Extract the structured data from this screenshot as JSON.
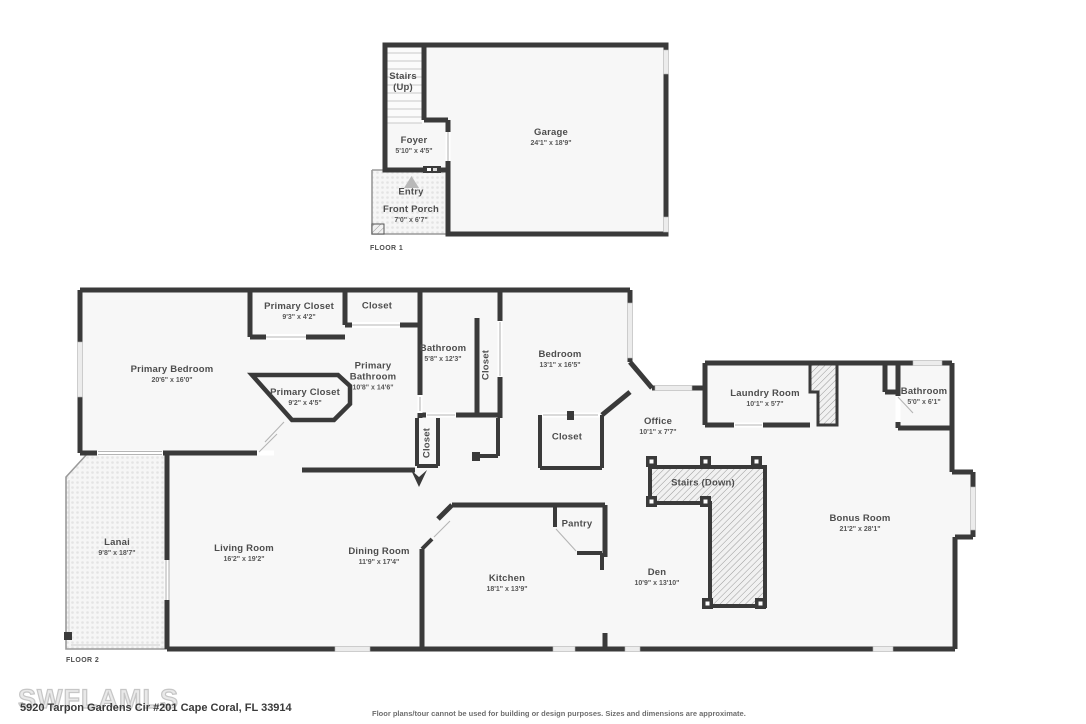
{
  "floor1": {
    "label": "FLOOR 1",
    "rooms": {
      "stairs_up": {
        "name": "Stairs",
        "name2": "(Up)"
      },
      "foyer": {
        "name": "Foyer",
        "dims": "5'10\" x 4'5\""
      },
      "entry": {
        "name": "Entry"
      },
      "front_porch": {
        "name": "Front Porch",
        "dims": "7'0\" x 6'7\""
      },
      "garage": {
        "name": "Garage",
        "dims": "24'1\" x 18'9\""
      }
    }
  },
  "floor2": {
    "label": "FLOOR 2",
    "rooms": {
      "primary_bedroom": {
        "name": "Primary Bedroom",
        "dims": "20'6\" x 16'0\""
      },
      "primary_closet_top": {
        "name": "Primary Closet",
        "dims": "9'3\" x 4'2\""
      },
      "closet_top": {
        "name": "Closet"
      },
      "primary_bathroom": {
        "name": "Primary",
        "name2": "Bathroom",
        "dims": "10'8\" x 14'6\""
      },
      "primary_closet_lower": {
        "name": "Primary Closet",
        "dims": "9'2\" x 4'5\""
      },
      "bathroom_mid": {
        "name": "Bathroom",
        "dims": "5'8\" x 12'3\""
      },
      "closet_bath": {
        "name": "Closet"
      },
      "bedroom": {
        "name": "Bedroom",
        "dims": "13'1\" x 16'5\""
      },
      "closet_hall": {
        "name": "Closet"
      },
      "closet_mid": {
        "name": "Closet"
      },
      "office": {
        "name": "Office",
        "dims": "10'1\" x 7'7\""
      },
      "laundry": {
        "name": "Laundry Room",
        "dims": "10'1\" x 5'7\""
      },
      "bathroom_right": {
        "name": "Bathroom",
        "dims": "5'0\" x 6'1\""
      },
      "stairs_down": {
        "name": "Stairs (Down)"
      },
      "lanai": {
        "name": "Lanai",
        "dims": "9'8\" x 18'7\""
      },
      "living": {
        "name": "Living Room",
        "dims": "16'2\" x 19'2\""
      },
      "dining": {
        "name": "Dining Room",
        "dims": "11'9\" x 17'4\""
      },
      "kitchen": {
        "name": "Kitchen",
        "dims": "18'1\" x 13'9\""
      },
      "pantry": {
        "name": "Pantry"
      },
      "den": {
        "name": "Den",
        "dims": "10'9\" x 13'10\""
      },
      "bonus": {
        "name": "Bonus Room",
        "dims": "21'2\" x 28'1\""
      }
    }
  },
  "footer": {
    "watermark": "SWFLAMLS",
    "address": "5920 Tarpon Gardens Cir #201 Cape Coral, FL 33914",
    "disclaimer": "Floor plans/tour cannot be used for building or design purposes. Sizes and dimensions are approximate."
  },
  "colors": {
    "wall": "#3a3a3a",
    "window": "#ececec",
    "floor": "#f7f7f7",
    "label": "#4d4d4d"
  }
}
